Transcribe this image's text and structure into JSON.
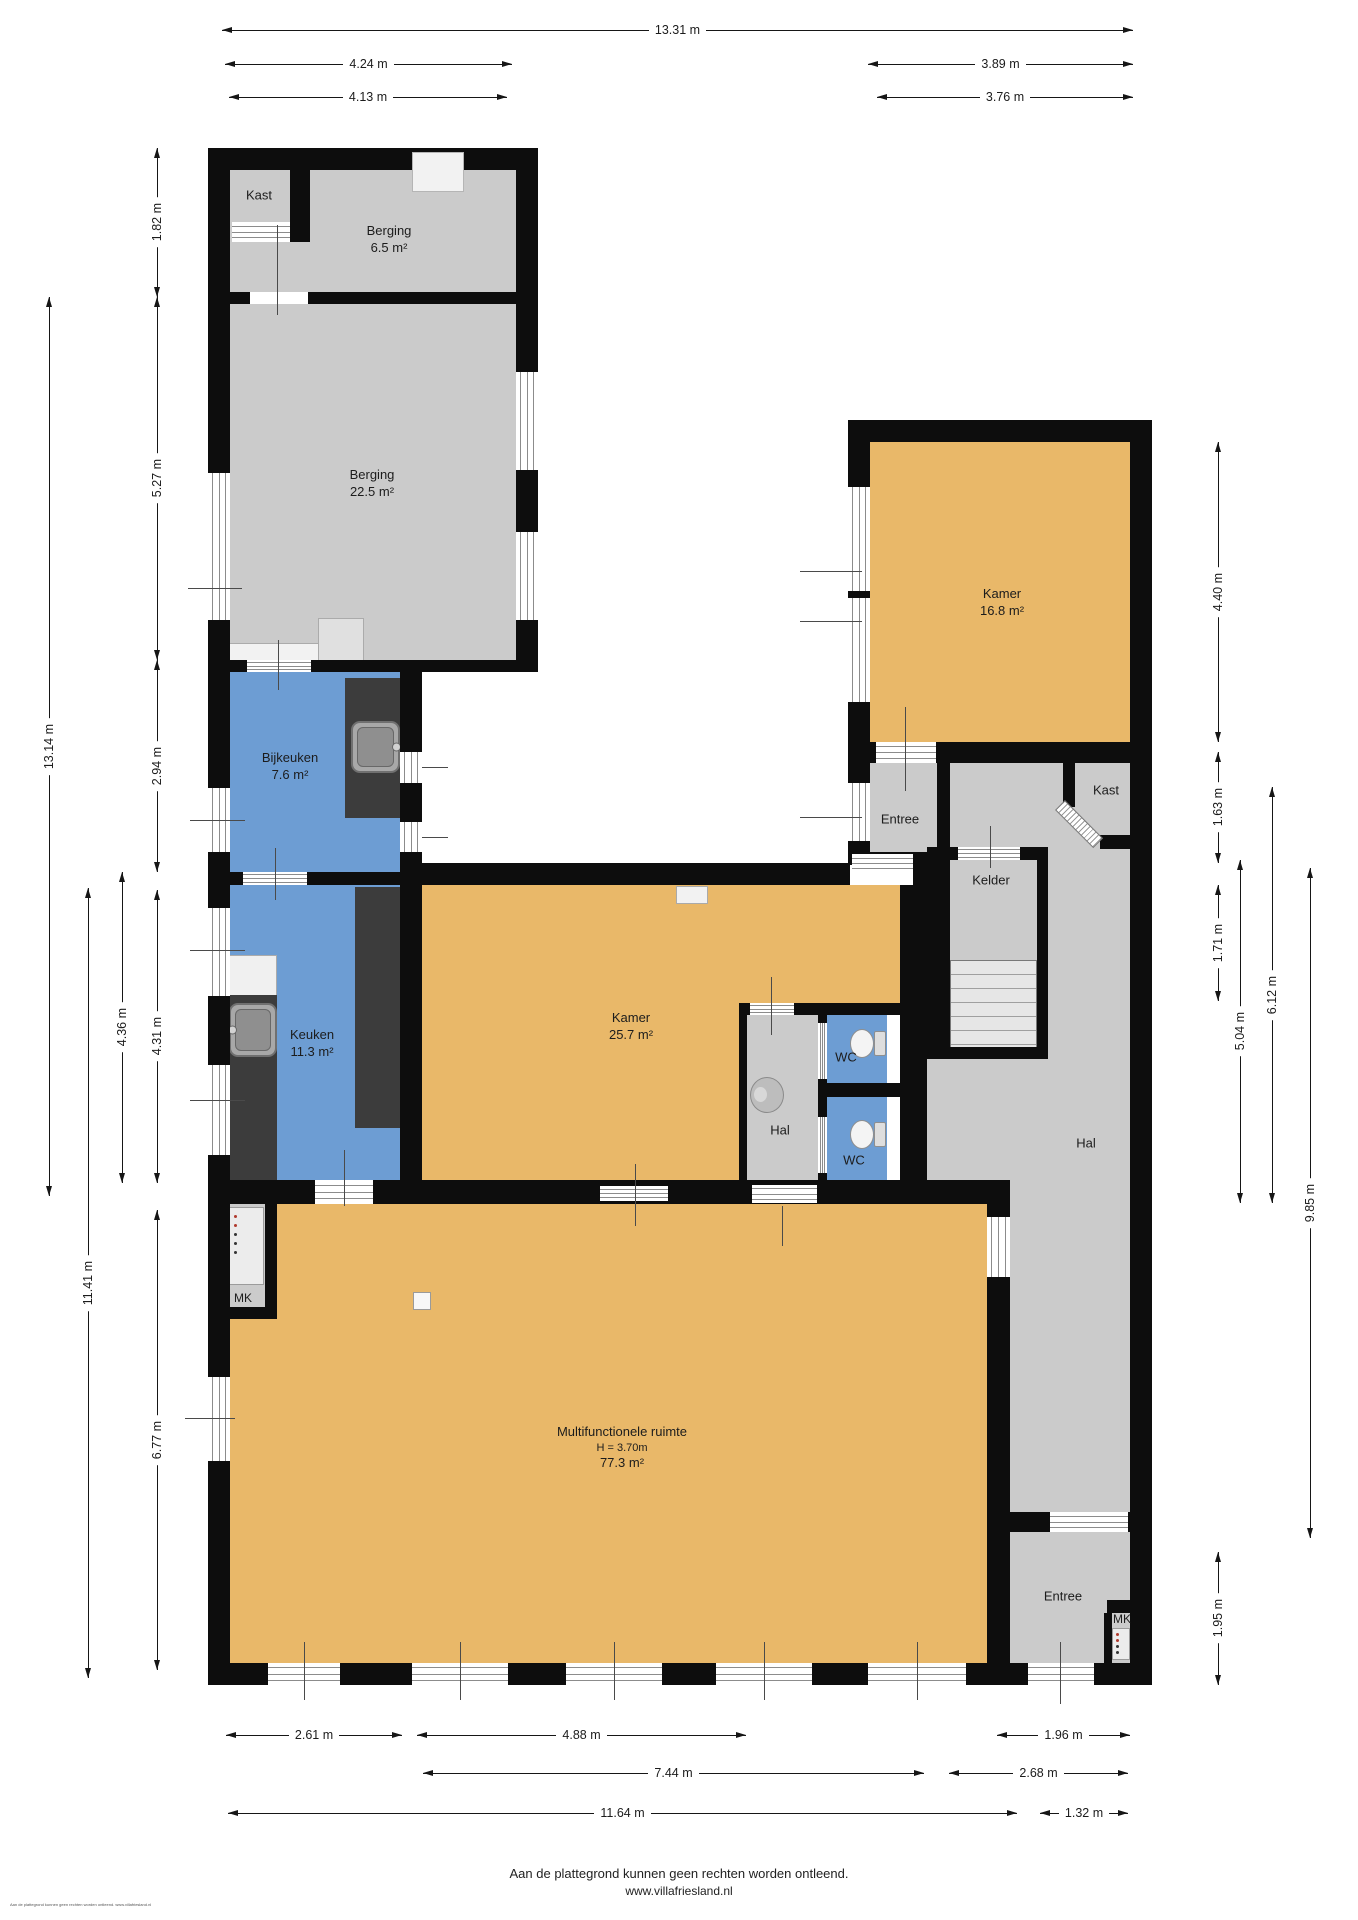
{
  "plan": {
    "rooms": [
      {
        "id": "kast-boven",
        "name": "Kast"
      },
      {
        "id": "berging-klein",
        "name": "Berging",
        "area": "6.5 m²"
      },
      {
        "id": "berging-groot",
        "name": "Berging",
        "area": "22.5 m²"
      },
      {
        "id": "bijkeuken",
        "name": "Bijkeuken",
        "area": "7.6 m²"
      },
      {
        "id": "keuken",
        "name": "Keuken",
        "area": "11.3 m²"
      },
      {
        "id": "kamer-midden",
        "name": "Kamer",
        "area": "25.7 m²"
      },
      {
        "id": "kamer-rechtsboven",
        "name": "Kamer",
        "area": "16.8 m²"
      },
      {
        "id": "entree-boven",
        "name": "Entree"
      },
      {
        "id": "kelder",
        "name": "Kelder"
      },
      {
        "id": "kast-rechts",
        "name": "Kast"
      },
      {
        "id": "hal-klein",
        "name": "Hal"
      },
      {
        "id": "wc-boven",
        "name": "WC"
      },
      {
        "id": "wc-onder",
        "name": "WC"
      },
      {
        "id": "hal-groot",
        "name": "Hal"
      },
      {
        "id": "meterkast-links",
        "name": "MK"
      },
      {
        "id": "multifunctionele-ruimte",
        "name": "Multifunctionele ruimte",
        "ceiling_height": "H = 3.70m",
        "area": "77.3 m²"
      },
      {
        "id": "entree-onder",
        "name": "Entree"
      },
      {
        "id": "meterkast-rechts",
        "name": "MK"
      }
    ],
    "dimensions": {
      "top": [
        {
          "label": "13.31 m"
        },
        {
          "label": "4.24 m"
        },
        {
          "label": "3.89 m"
        },
        {
          "label": "4.13 m"
        },
        {
          "label": "3.76 m"
        }
      ],
      "left": [
        {
          "label": "1.82 m"
        },
        {
          "label": "5.27 m"
        },
        {
          "label": "2.94 m"
        },
        {
          "label": "4.31 m"
        },
        {
          "label": "6.77 m"
        },
        {
          "label": "13.14 m"
        },
        {
          "label": "4.36 m"
        },
        {
          "label": "11.41 m"
        }
      ],
      "right": [
        {
          "label": "4.40 m"
        },
        {
          "label": "1.63 m"
        },
        {
          "label": "1.71 m"
        },
        {
          "label": "1.95 m"
        },
        {
          "label": "5.04 m"
        },
        {
          "label": "6.12 m"
        },
        {
          "label": "9.85 m"
        }
      ],
      "bottom": [
        {
          "label": "2.61 m"
        },
        {
          "label": "4.88 m"
        },
        {
          "label": "1.96 m"
        },
        {
          "label": "7.44 m"
        },
        {
          "label": "2.68 m"
        },
        {
          "label": "11.64 m"
        },
        {
          "label": "1.32 m"
        }
      ]
    },
    "colors": {
      "wall": "#0d0d0d",
      "room_gray": "#cbcbcb",
      "room_orange": "#e9b869",
      "room_blue": "#6d9dd3",
      "counter_dark": "#3c3c3c"
    },
    "footer": {
      "disclaimer": "Aan de plattegrond kunnen geen rechten worden ontleend.",
      "website": "www.villafriesland.nl",
      "small_print": "Aan de plattegrond kunnen geen rechten worden ontleend. www.villafriesland.nl"
    }
  }
}
